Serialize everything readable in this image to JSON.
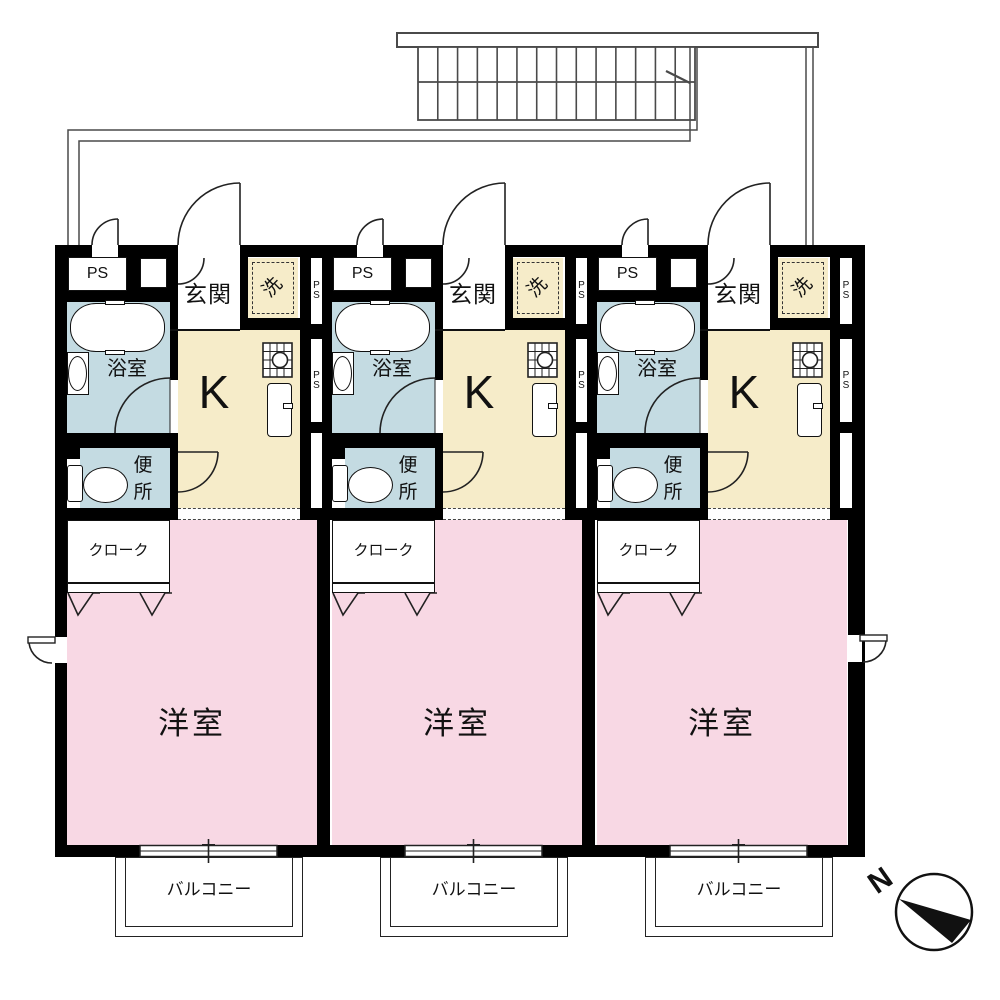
{
  "floor_plan": {
    "units": [
      {
        "id": "unit-1"
      },
      {
        "id": "unit-2"
      },
      {
        "id": "unit-3"
      }
    ]
  },
  "labels": {
    "pipe_space_box": "PS",
    "pipe_space_shaft": "PS",
    "entrance": "玄関",
    "washer": "洗",
    "bathroom": "浴室",
    "kitchen": "K",
    "toilet": "便所",
    "closet": "クローク",
    "western_room": "洋室",
    "balcony": "バルコニー"
  },
  "compass": {
    "north_label": "N"
  },
  "colors": {
    "wall": "#000000",
    "wet_area": "#c4dbe2",
    "kitchen_floor": "#f6ecc9",
    "room_floor": "#f8d8e4",
    "outline": "#444444"
  }
}
